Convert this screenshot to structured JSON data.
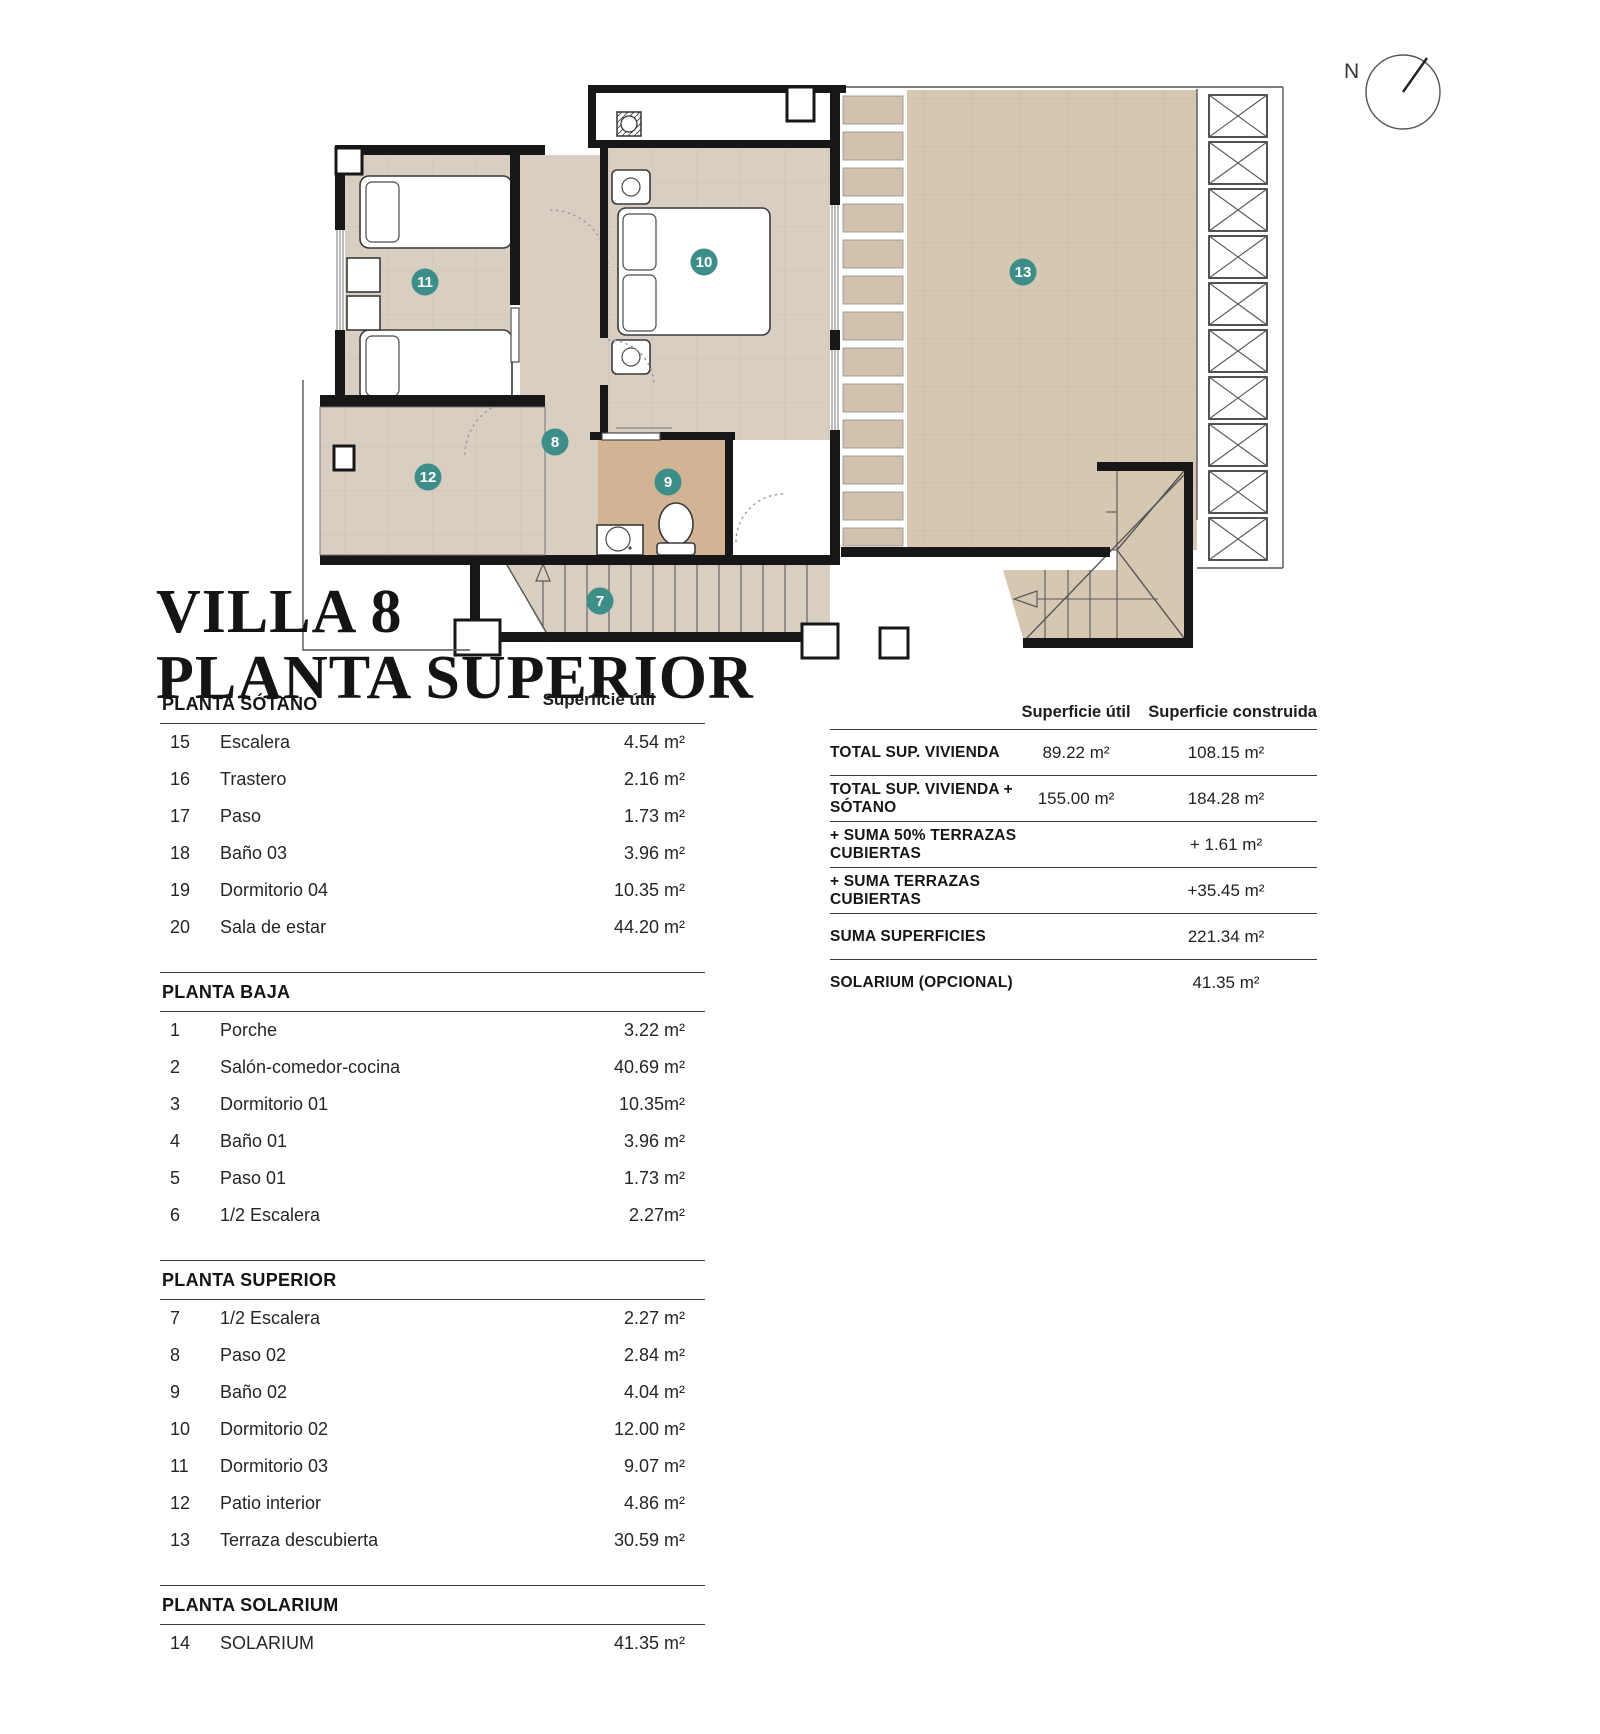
{
  "title": {
    "line1": "VILLA 8",
    "line2": "PLANTA SUPERIOR"
  },
  "north": {
    "label": "N"
  },
  "colors": {
    "badge": "#3D8E88",
    "floor": "#D9CEC2",
    "floor_dark": "#D2B494",
    "terrace": "#D6C7B3",
    "slat": "#D2C2AD",
    "wall": "#171717"
  },
  "plan": {
    "badges": [
      {
        "n": "7"
      },
      {
        "n": "8"
      },
      {
        "n": "9"
      },
      {
        "n": "10"
      },
      {
        "n": "11"
      },
      {
        "n": "12"
      },
      {
        "n": "13"
      }
    ]
  },
  "left_table": {
    "value_header": "Superficie útil",
    "sections": [
      {
        "header": "PLANTA SÓTANO",
        "rows": [
          [
            "15",
            "Escalera",
            "4.54 m²"
          ],
          [
            "16",
            "Trastero",
            "2.16 m²"
          ],
          [
            "17",
            "Paso",
            "1.73 m²"
          ],
          [
            "18",
            "Baño 03",
            "3.96 m²"
          ],
          [
            "19",
            "Dormitorio 04",
            "10.35 m²"
          ],
          [
            "20",
            "Sala de estar",
            "44.20 m²"
          ]
        ]
      },
      {
        "header": "PLANTA BAJA",
        "rows": [
          [
            "1",
            "Porche",
            "3.22 m²"
          ],
          [
            "2",
            "Salón-comedor-cocina",
            "40.69 m²"
          ],
          [
            "3",
            "Dormitorio 01",
            "10.35m²"
          ],
          [
            "4",
            "Baño 01",
            "3.96 m²"
          ],
          [
            "5",
            "Paso 01",
            "1.73 m²"
          ],
          [
            "6",
            "1/2 Escalera",
            "2.27m²"
          ]
        ]
      },
      {
        "header": "PLANTA SUPERIOR",
        "rows": [
          [
            "7",
            "1/2 Escalera",
            "2.27 m²"
          ],
          [
            "8",
            "Paso 02",
            "2.84 m²"
          ],
          [
            "9",
            "Baño 02",
            "4.04 m²"
          ],
          [
            "10",
            "Dormitorio 02",
            "12.00 m²"
          ],
          [
            "11",
            "Dormitorio 03",
            "9.07 m²"
          ],
          [
            "12",
            "Patio interior",
            "4.86 m²"
          ],
          [
            "13",
            "Terraza descubierta",
            "30.59 m²"
          ]
        ]
      },
      {
        "header": "PLANTA SOLARIUM",
        "rows": [
          [
            "14",
            "SOLARIUM",
            "41.35 m²"
          ]
        ]
      }
    ]
  },
  "right_table": {
    "col1_header": "Superficie útil",
    "col2_header": "Superficie construida",
    "rows": [
      {
        "label": "TOTAL SUP. VIVIENDA",
        "util": "89.22 m²",
        "constr": "108.15 m²"
      },
      {
        "label": "TOTAL SUP. VIVIENDA + SÓTANO",
        "util": "155.00 m²",
        "constr": "184.28 m²"
      },
      {
        "label": "+ SUMA 50% TERRAZAS CUBIERTAS",
        "util": "",
        "constr": "+ 1.61 m²"
      },
      {
        "label": "+ SUMA TERRAZAS CUBIERTAS",
        "util": "",
        "constr": "+35.45 m²"
      },
      {
        "label": "SUMA SUPERFICIES",
        "util": "",
        "constr": "221.34 m²"
      },
      {
        "label": "SOLARIUM (OPCIONAL)",
        "util": "",
        "constr": "41.35 m²"
      }
    ]
  }
}
